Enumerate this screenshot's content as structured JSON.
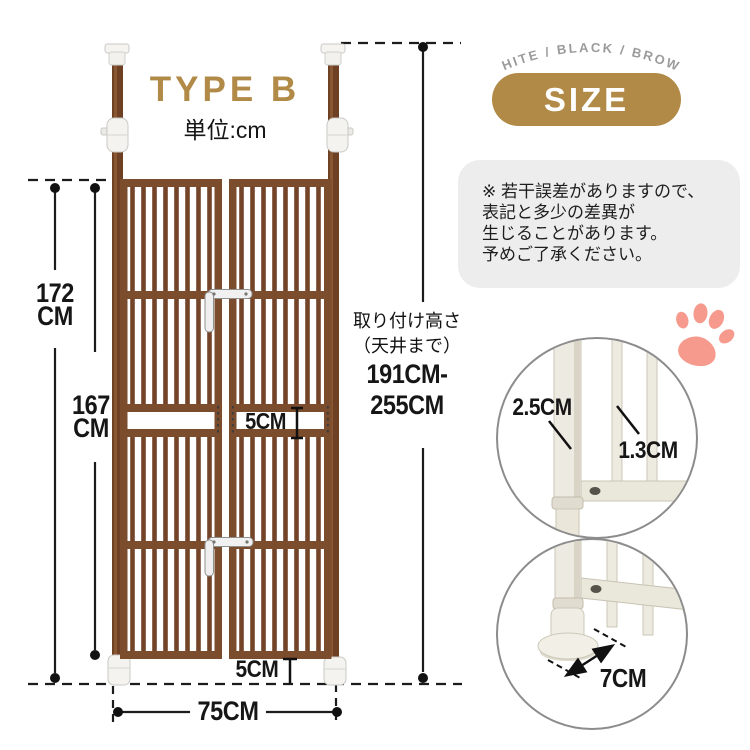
{
  "header": {
    "type_label": "TYPE B",
    "unit_label": "単位:cm",
    "color_options": "WHITE / BLACK / BROWN",
    "size_badge": "SIZE"
  },
  "note": {
    "lines": [
      "※ 若干誤差がありますので、",
      "表記と多少の差異が",
      "生じることがあります。",
      "予めご了承ください。"
    ]
  },
  "dimensions": {
    "total_height": {
      "value": "172",
      "unit": "CM"
    },
    "panel_height": {
      "value": "167",
      "unit": "CM"
    },
    "install_height": {
      "title": "取り付け高さ",
      "subtitle": "（天井まで）",
      "range_line1": "191CM-",
      "range_line2": "255CM"
    },
    "mid_gap": "5CM",
    "floor_gap": "5CM",
    "width": "75CM",
    "pole_diameter": "2.5CM",
    "bar_diameter": "1.3CM",
    "foot_depth": "7CM"
  },
  "colors": {
    "accent_gold": "#b18a47",
    "gate_brown": "#78482a",
    "paw_pink": "#f59a8c",
    "note_background": "#ededed",
    "option_text_gray": "#9b9b9b"
  },
  "icons": {
    "paw": "paw-print"
  }
}
